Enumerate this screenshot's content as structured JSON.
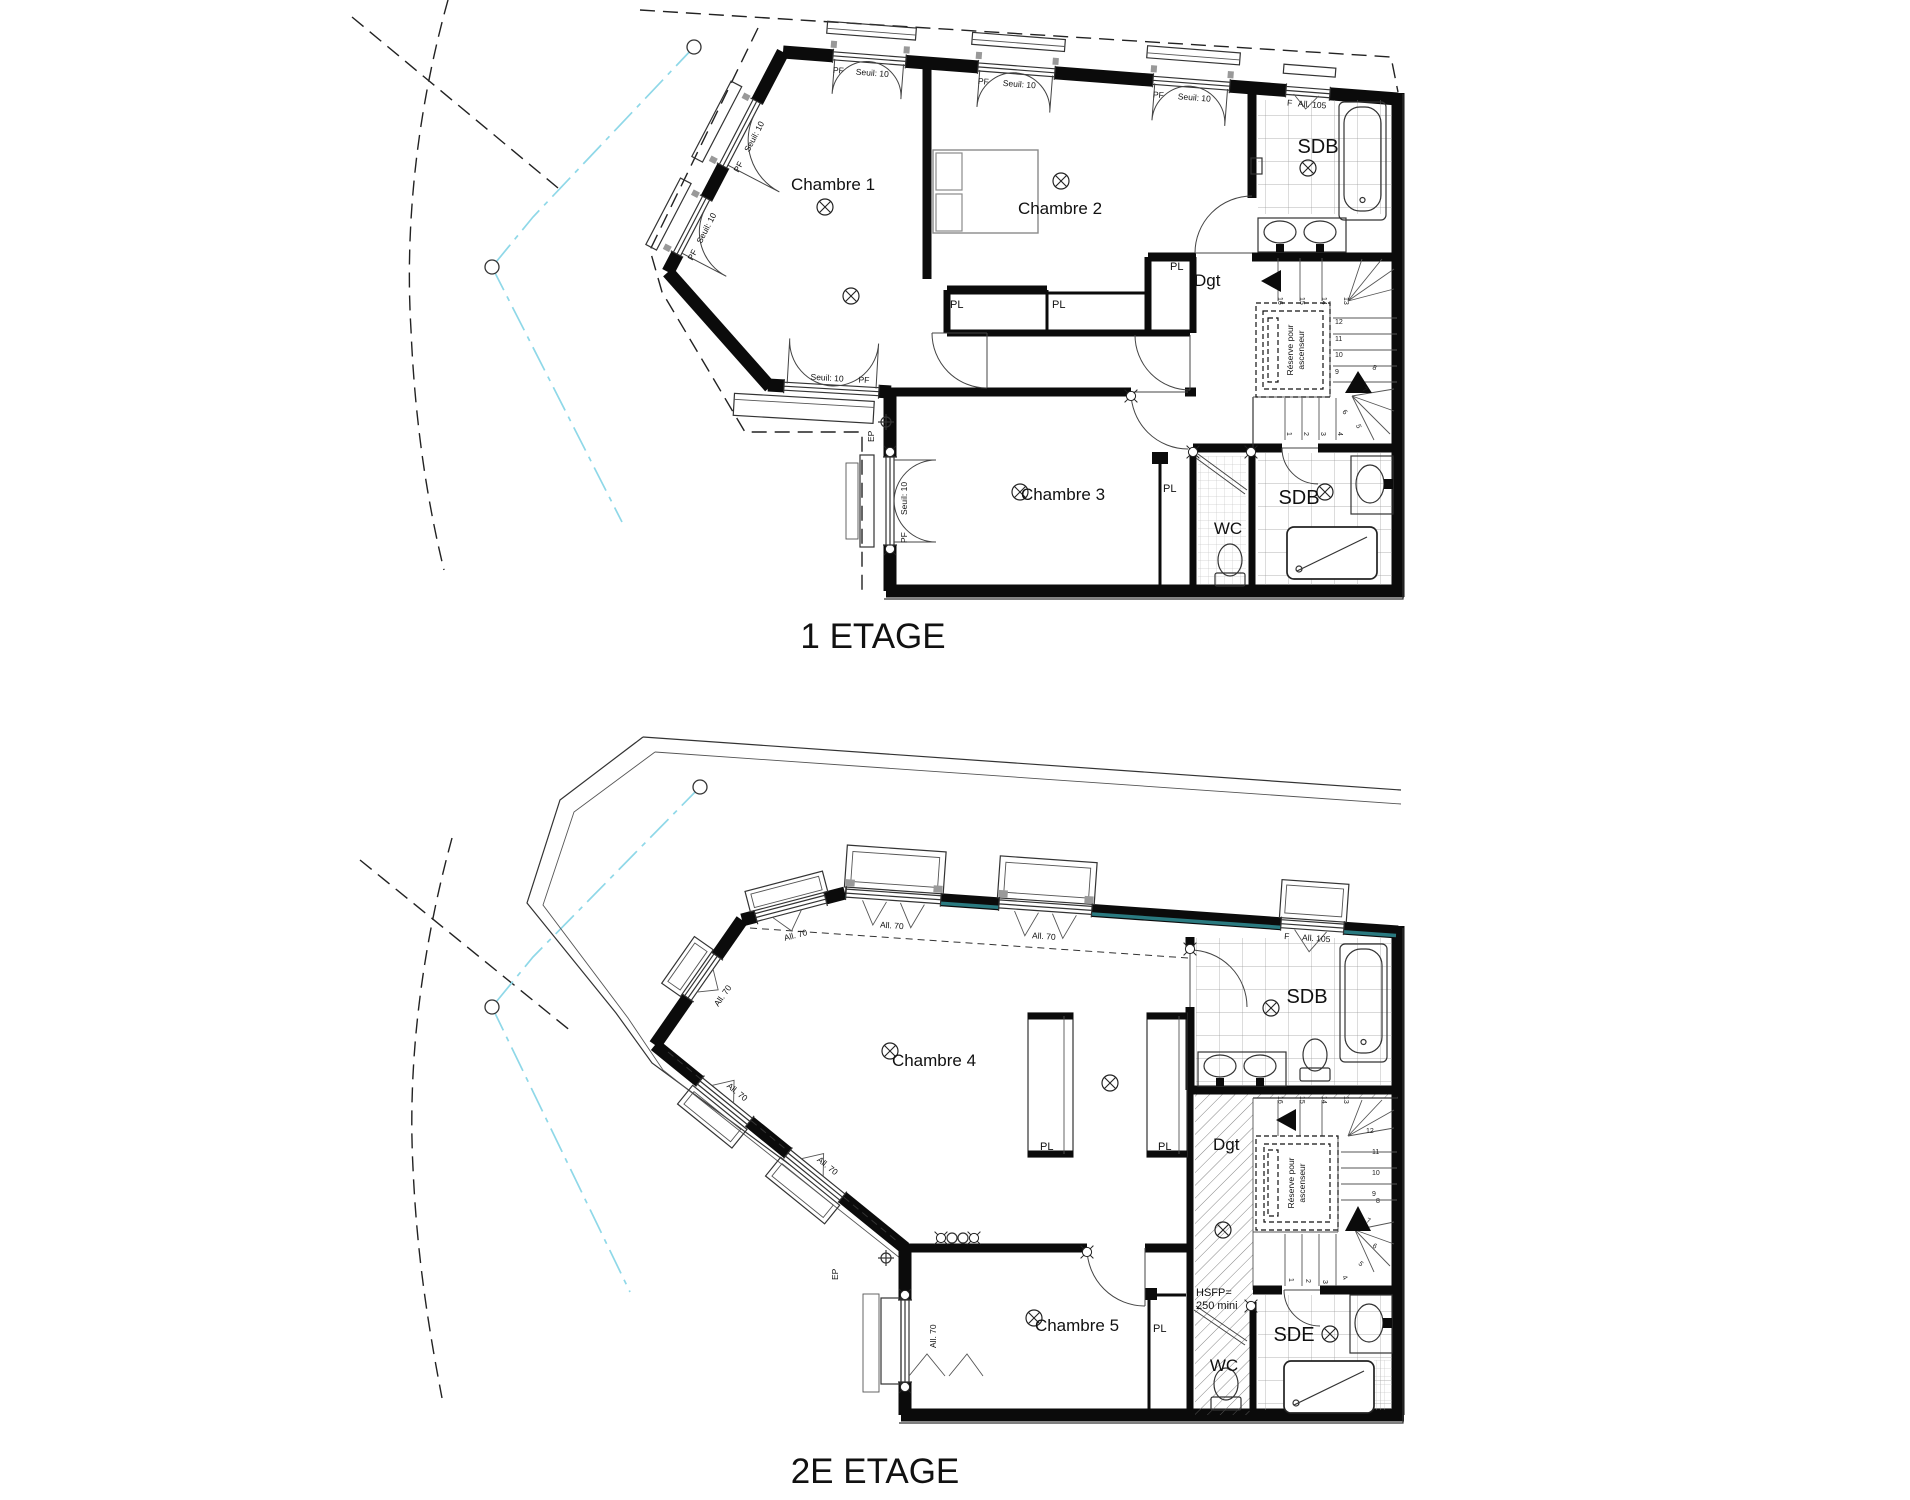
{
  "titles": {
    "floor1": "1 ETAGE",
    "floor2": "2E ETAGE"
  },
  "floor1": {
    "rooms": {
      "chambre1": "Chambre 1",
      "chambre2": "Chambre 2",
      "chambre3": "Chambre 3",
      "sdb_top": "SDB",
      "sdb_bottom": "SDB",
      "wc": "WC",
      "dgt": "Dgt"
    }
  },
  "floor2": {
    "rooms": {
      "chambre4": "Chambre 4",
      "chambre5": "Chambre 5",
      "sdb": "SDB",
      "sde": "SDE",
      "wc": "WC",
      "dgt": "Dgt"
    },
    "notes": {
      "hsfp_line1": "HSFP=",
      "hsfp_line2": "250 mini"
    }
  },
  "labels": {
    "pl": "PL",
    "pf": "PF",
    "seuil": "Seuil: 10",
    "fixed": "F",
    "all105": "All. 105",
    "all70": "All. 70",
    "ep": "EP",
    "reserve_line1": "Réserve pour",
    "reserve_line2": "ascenseur"
  },
  "stair_numbers": [
    "1",
    "2",
    "3",
    "4",
    "5",
    "6",
    "7",
    "8",
    "9",
    "10",
    "11",
    "12",
    "13",
    "14",
    "15",
    "16"
  ],
  "colors": {
    "wall": "#0b0b0b",
    "boundary_cyan": "#8fd8e8",
    "glazing_teal": "#2a7a80"
  }
}
